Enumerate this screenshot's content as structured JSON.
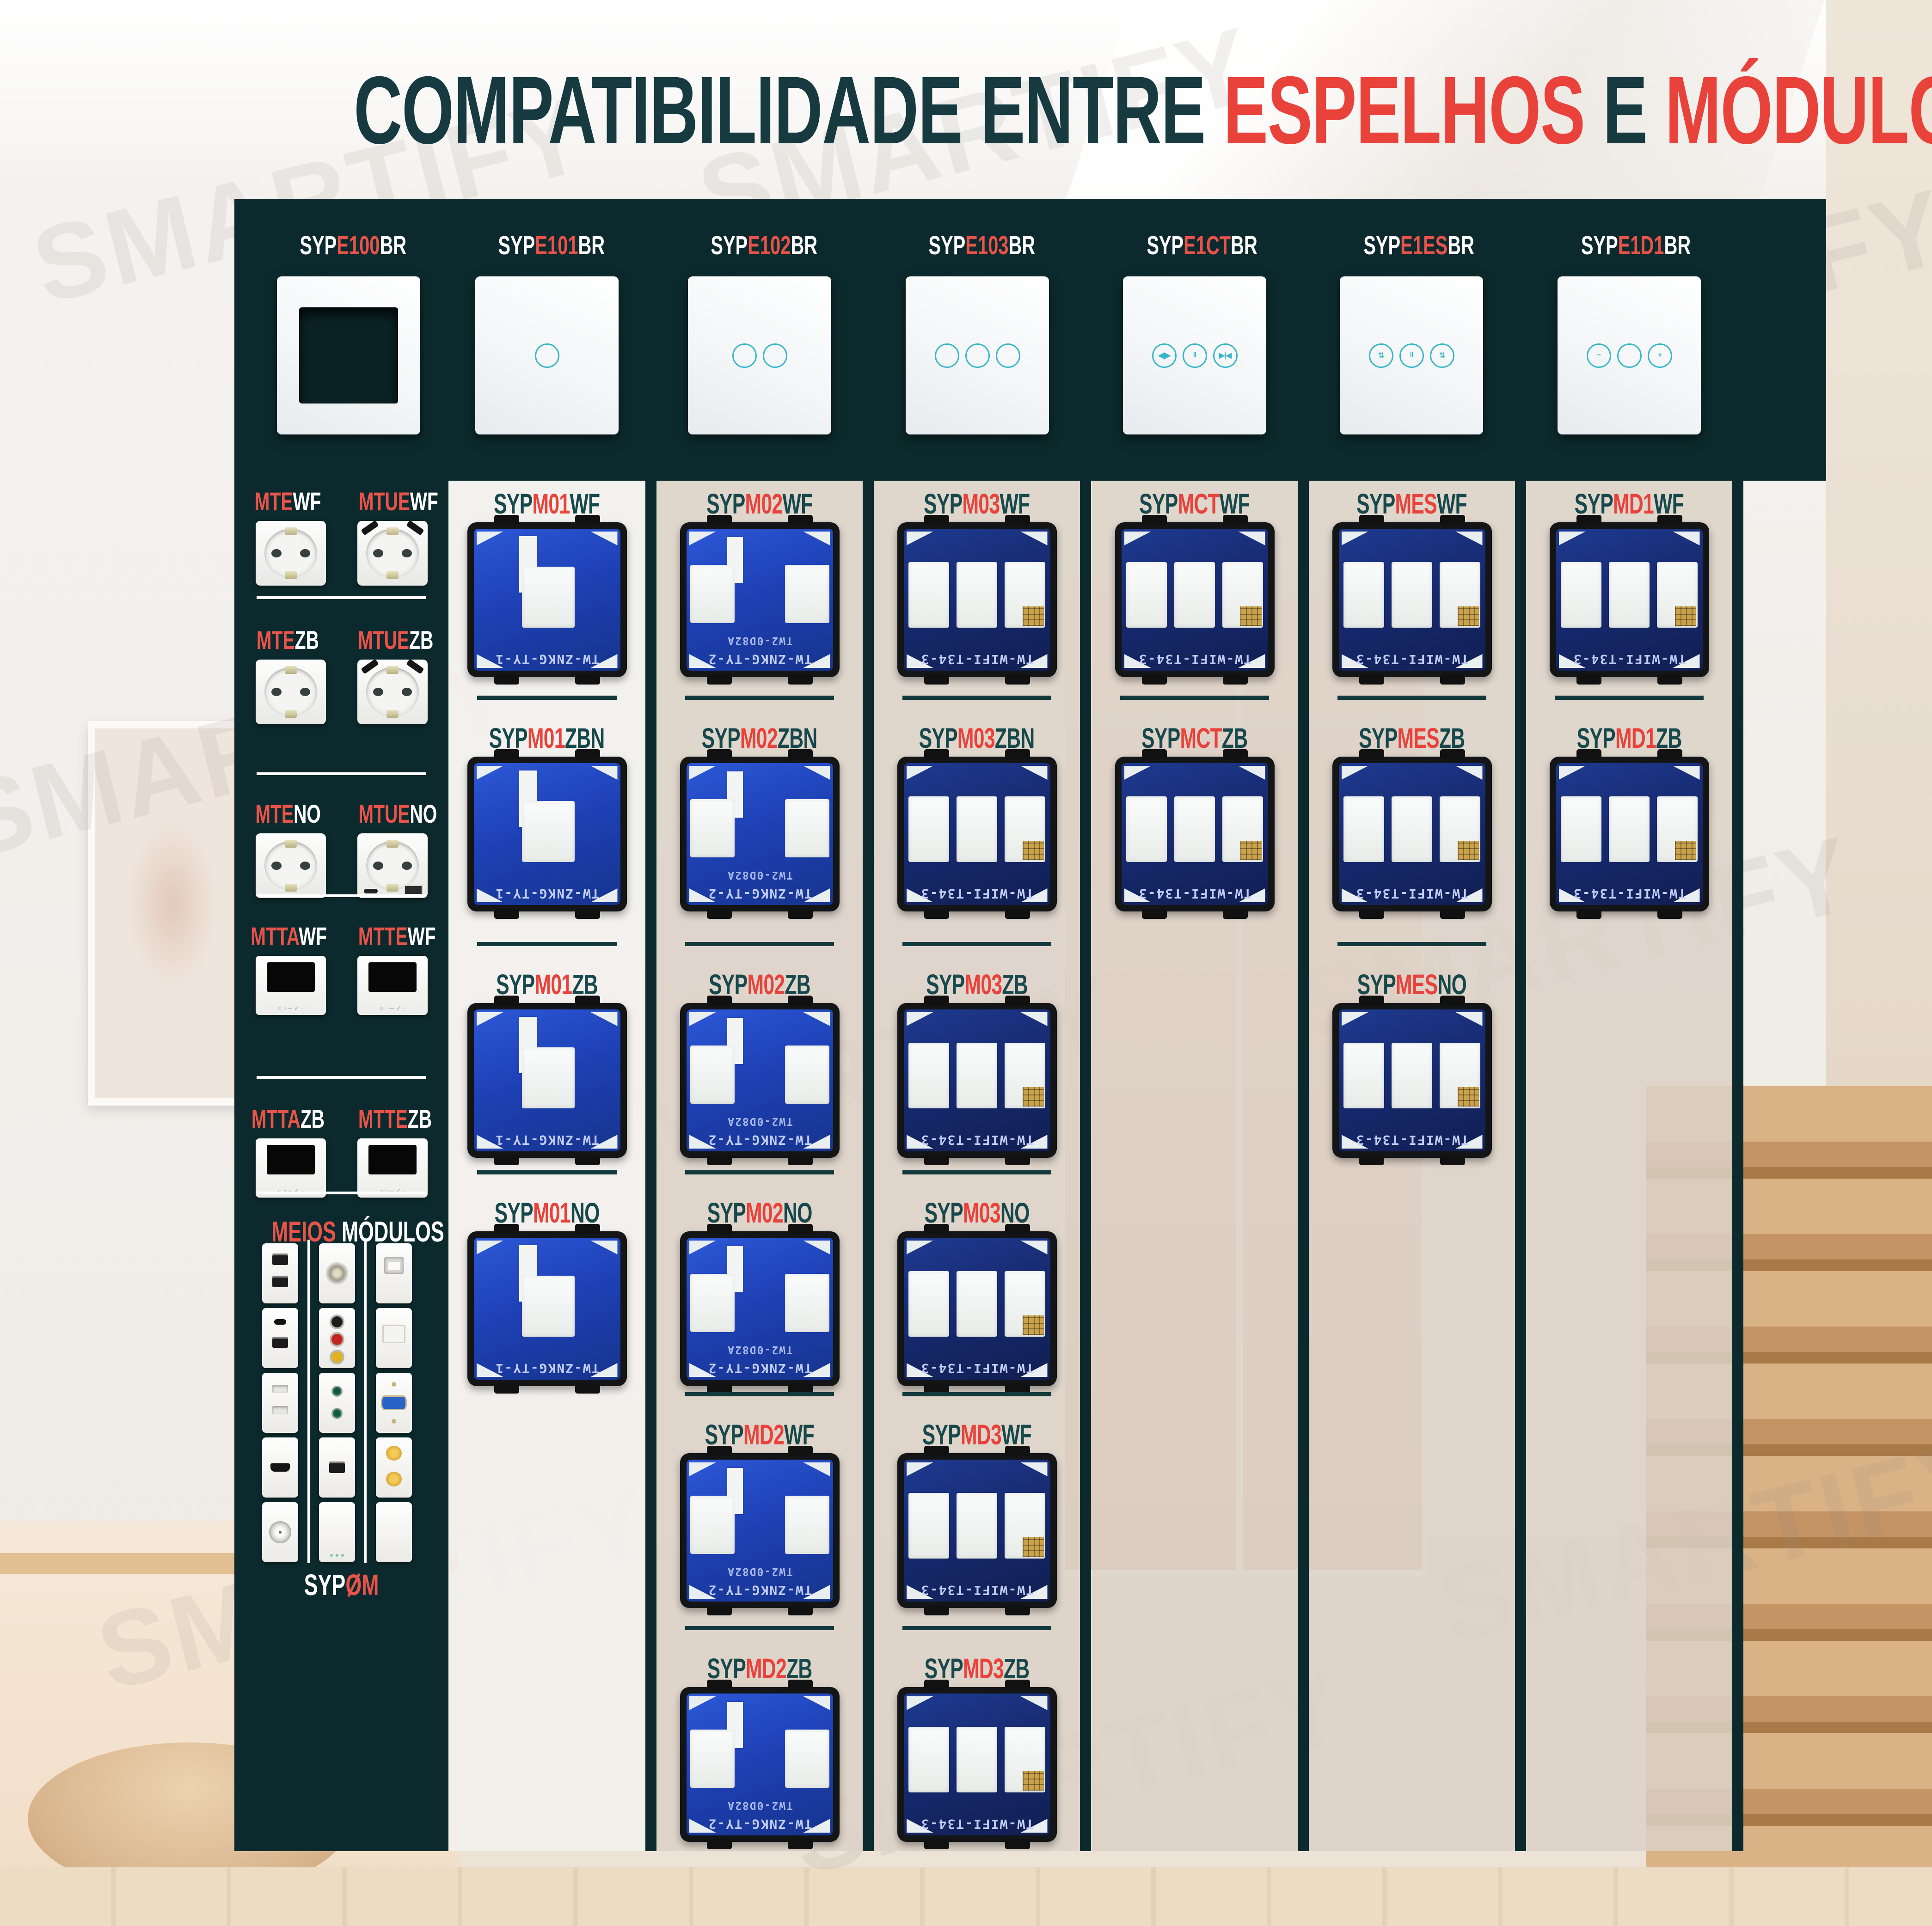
{
  "title": {
    "part1": "COMPATIBILIDADE ENTRE ",
    "part2": "ESPELHOS ",
    "part3": "E ",
    "part4": "MÓDULOS"
  },
  "watermark": "SMARTIFY",
  "colors": {
    "teal_band": "#0c2a2d",
    "red": "#e8423b",
    "label_teal": "#17484b",
    "touch_icon": "#36b7c8",
    "pcb_blue": "#1e41b6",
    "pcb_navy": "#17296e"
  },
  "header": {
    "panels": [
      {
        "prefix": "SYP",
        "mid": "E100",
        "suffix": "BR",
        "type": "frame",
        "buttons": []
      },
      {
        "prefix": "SYP",
        "mid": "E101",
        "suffix": "BR",
        "type": "touch",
        "buttons": [
          ""
        ]
      },
      {
        "prefix": "SYP",
        "mid": "E102",
        "suffix": "BR",
        "type": "touch",
        "buttons": [
          "",
          ""
        ]
      },
      {
        "prefix": "SYP",
        "mid": "E103",
        "suffix": "BR",
        "type": "touch",
        "buttons": [
          "",
          "",
          ""
        ]
      },
      {
        "prefix": "SYP",
        "mid": "E1CT",
        "suffix": "BR",
        "type": "touch",
        "buttons": [
          "◀|▶",
          "‖",
          "▶|◀"
        ]
      },
      {
        "prefix": "SYP",
        "mid": "E1ES",
        "suffix": "BR",
        "type": "touch",
        "buttons": [
          "⇅",
          "‖",
          "⇅"
        ]
      },
      {
        "prefix": "SYP",
        "mid": "E1D1",
        "suffix": "BR",
        "type": "touch",
        "buttons": [
          "−",
          "",
          "+"
        ]
      }
    ]
  },
  "sidebar": {
    "sections": [
      {
        "items": [
          {
            "label_red": "MTE",
            "label_suffix": "WF",
            "type": "socket"
          },
          {
            "label_red": "MTUE",
            "label_suffix": "WF",
            "type": "socket-usb"
          }
        ]
      },
      {
        "items": [
          {
            "label_red": "MTE",
            "label_suffix": "ZB",
            "type": "socket"
          },
          {
            "label_red": "MTUE",
            "label_suffix": "ZB",
            "type": "socket-usb"
          }
        ]
      },
      {
        "items": [
          {
            "label_red": "MTE",
            "label_suffix": "NO",
            "type": "socket"
          },
          {
            "label_red": "MTUE",
            "label_suffix": "NO",
            "type": "socket-usbno"
          }
        ]
      },
      {
        "items": [
          {
            "label_red": "MTTA",
            "label_suffix": "WF",
            "type": "thermostat"
          },
          {
            "label_red": "MTTE",
            "label_suffix": "WF",
            "type": "thermostat"
          }
        ]
      },
      {
        "items": [
          {
            "label_red": "MTTA",
            "label_suffix": "ZB",
            "type": "thermostat"
          },
          {
            "label_red": "MTTE",
            "label_suffix": "ZB",
            "type": "thermostat"
          }
        ]
      }
    ],
    "meios": {
      "heading_red": "MEIOS",
      "heading_rest": " MÓDULOS",
      "cells": [
        [
          "usb-double",
          "speaker",
          "rj45"
        ],
        [
          "usb-c-usb-a",
          "rca",
          "keystone"
        ],
        [
          "flat-2pin",
          "jack-double",
          "vga"
        ],
        [
          "hdmi",
          "usb-single",
          "banana-double"
        ],
        [
          "tv-coax",
          "blank-plate",
          "blank"
        ]
      ],
      "footer_prefix": "SYP",
      "footer_suffix": "OM"
    }
  },
  "columns": [
    {
      "modules": [
        {
          "prefix": "SYP",
          "mid": "M01",
          "suffix": "WF",
          "gangs": 1,
          "pcb_text": "TW-ZNKG-TY-1"
        },
        {
          "prefix": "SYP",
          "mid": "M01",
          "suffix": "ZBN",
          "gangs": 1,
          "pcb_text": "TW-ZNKG-TY-1"
        },
        {
          "prefix": "SYP",
          "mid": "M01",
          "suffix": "ZB",
          "gangs": 1,
          "pcb_text": "TW-ZNKG-TY-1"
        },
        {
          "prefix": "SYP",
          "mid": "M01",
          "suffix": "NO",
          "gangs": 1,
          "pcb_text": "TW-ZNKG-TY-1"
        }
      ]
    },
    {
      "modules": [
        {
          "prefix": "SYP",
          "mid": "M02",
          "suffix": "WF",
          "gangs": 2,
          "pcb_text": "TW-ZNKG-TY-2",
          "pcb_text2": "TW2-0D82A"
        },
        {
          "prefix": "SYP",
          "mid": "M02",
          "suffix": "ZBN",
          "gangs": 2,
          "pcb_text": "TW-ZNKG-TY-2",
          "pcb_text2": "TW2-0D82A"
        },
        {
          "prefix": "SYP",
          "mid": "M02",
          "suffix": "ZB",
          "gangs": 2,
          "pcb_text": "TW-ZNKG-TY-2",
          "pcb_text2": "TW2-0D82A"
        },
        {
          "prefix": "SYP",
          "mid": "M02",
          "suffix": "NO",
          "gangs": 2,
          "pcb_text": "TW-ZNKG-TY-2",
          "pcb_text2": "TW2-0D82A"
        },
        {
          "prefix": "SYP",
          "mid": "MD2",
          "suffix": "WF",
          "gangs": 2,
          "pcb_text": "TW-ZNKG-TY-2",
          "pcb_text2": "TW2-0D82A"
        },
        {
          "prefix": "SYP",
          "mid": "MD2",
          "suffix": "ZB",
          "gangs": 2,
          "pcb_text": "TW-ZNKG-TY-2",
          "pcb_text2": "TW2-0D82A"
        }
      ]
    },
    {
      "modules": [
        {
          "prefix": "SYP",
          "mid": "M03",
          "suffix": "WF",
          "gangs": 3,
          "pcb_text": "TW-WIFI-T34-3"
        },
        {
          "prefix": "SYP",
          "mid": "M03",
          "suffix": "ZBN",
          "gangs": 3,
          "pcb_text": "TW-WIFI-T34-3"
        },
        {
          "prefix": "SYP",
          "mid": "M03",
          "suffix": "ZB",
          "gangs": 3,
          "pcb_text": "TW-WIFI-T34-3"
        },
        {
          "prefix": "SYP",
          "mid": "M03",
          "suffix": "NO",
          "gangs": 3,
          "pcb_text": "TW-WIFI-T34-3"
        },
        {
          "prefix": "SYP",
          "mid": "MD3",
          "suffix": "WF",
          "gangs": 3,
          "pcb_text": "TW-WIFI-T34-3"
        },
        {
          "prefix": "SYP",
          "mid": "MD3",
          "suffix": "ZB",
          "gangs": 3,
          "pcb_text": "TW-WIFI-T34-3"
        }
      ]
    },
    {
      "modules": [
        {
          "prefix": "SYP",
          "mid": "MCT",
          "suffix": "WF",
          "gangs": 3,
          "pcb_text": "TW-WIFI-T34-3"
        },
        {
          "prefix": "SYP",
          "mid": "MCT",
          "suffix": "ZB",
          "gangs": 3,
          "pcb_text": "TW-WIFI-T34-3"
        }
      ]
    },
    {
      "modules": [
        {
          "prefix": "SYP",
          "mid": "MES",
          "suffix": "WF",
          "gangs": 3,
          "pcb_text": "TW-WIFI-T34-3"
        },
        {
          "prefix": "SYP",
          "mid": "MES",
          "suffix": "ZB",
          "gangs": 3,
          "pcb_text": "TW-WIFI-T34-3"
        },
        {
          "prefix": "SYP",
          "mid": "MES",
          "suffix": "NO",
          "gangs": 3,
          "pcb_text": "TW-WIFI-T34-3"
        }
      ]
    },
    {
      "modules": [
        {
          "prefix": "SYP",
          "mid": "MD1",
          "suffix": "WF",
          "gangs": 3,
          "pcb_text": "TW-WIFI-T34-3"
        },
        {
          "prefix": "SYP",
          "mid": "MD1",
          "suffix": "ZB",
          "gangs": 3,
          "pcb_text": "TW-WIFI-T34-3"
        }
      ]
    }
  ]
}
